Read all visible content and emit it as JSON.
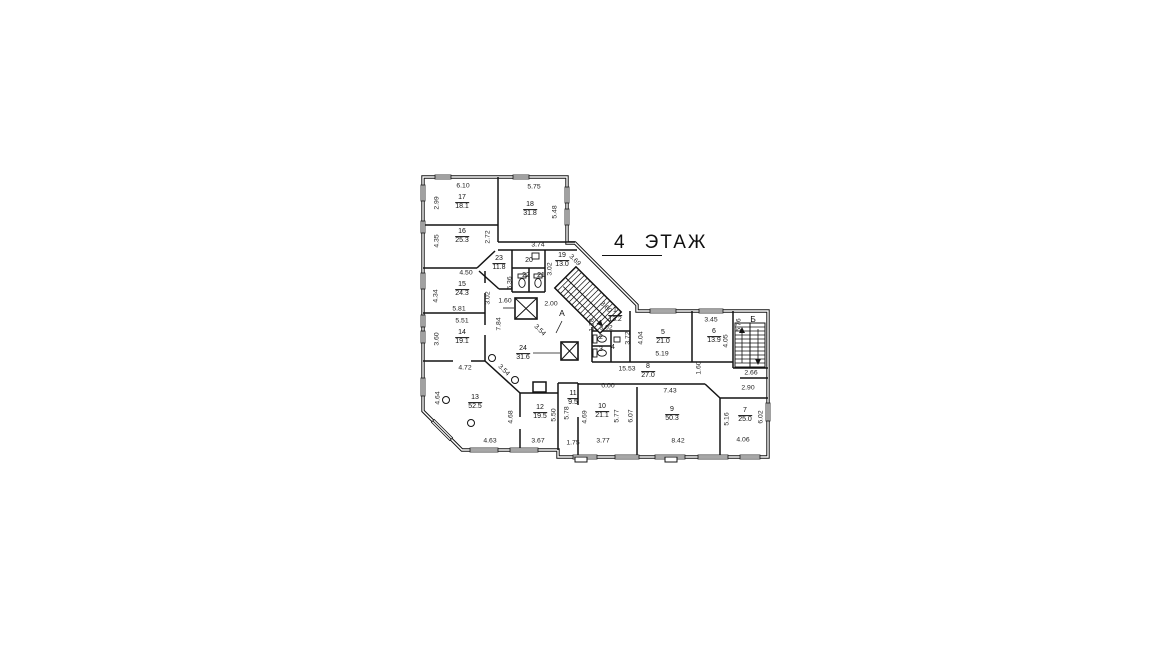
{
  "title": {
    "floor_number": "4",
    "floor_word": "ЭТАЖ"
  },
  "axis_labels": {
    "a": "А",
    "b": "Б"
  },
  "rooms": [
    {
      "num": "17",
      "area": "18.1"
    },
    {
      "num": "18",
      "area": "31.8"
    },
    {
      "num": "16",
      "area": "25.3"
    },
    {
      "num": "23",
      "area": "11.8"
    },
    {
      "num": "20",
      "area": ""
    },
    {
      "num": "19",
      "area": "13.0"
    },
    {
      "num": "22",
      "area": ""
    },
    {
      "num": "21",
      "area": ""
    },
    {
      "num": "15",
      "area": "24.3"
    },
    {
      "num": "14",
      "area": "19.1"
    },
    {
      "num": "24",
      "area": "31.6"
    },
    {
      "num": "1",
      "area": "13.2"
    },
    {
      "num": "2",
      "area": ""
    },
    {
      "num": "3",
      "area": ""
    },
    {
      "num": "4",
      "area": ""
    },
    {
      "num": "5",
      "area": "21.0"
    },
    {
      "num": "6",
      "area": "13.9"
    },
    {
      "num": "8",
      "area": "27.0"
    },
    {
      "num": "13",
      "area": "52.5"
    },
    {
      "num": "12",
      "area": "19.5"
    },
    {
      "num": "11",
      "area": "9.5"
    },
    {
      "num": "10",
      "area": "21.1"
    },
    {
      "num": "9",
      "area": "50.3"
    },
    {
      "num": "7",
      "area": "25.0"
    }
  ],
  "dims": [
    "6.10",
    "2.99",
    "5.75",
    "5.48",
    "4.35",
    "2.72",
    "3.74",
    "4.50",
    "4.34",
    "3.02",
    "5.81",
    "1.60",
    "2.00",
    "5.51",
    "7.84",
    "3.60",
    "6.36",
    "3.02",
    "3.69",
    "3.60",
    "1.28",
    "3.02",
    "3.72",
    "4.04",
    "3.45",
    "5.76",
    "4.05",
    "5.19",
    "15.53",
    "1.60",
    "2.66",
    "2.90",
    "4.72",
    "3.54",
    "3.54",
    "4.64",
    "0.00",
    "7.43",
    "4.68",
    "5.50",
    "5.78",
    "4.69",
    "5.77",
    "6.07",
    "5.16",
    "6.02",
    "4.63",
    "3.67",
    "1.75",
    "3.77",
    "8.42",
    "4.06"
  ]
}
